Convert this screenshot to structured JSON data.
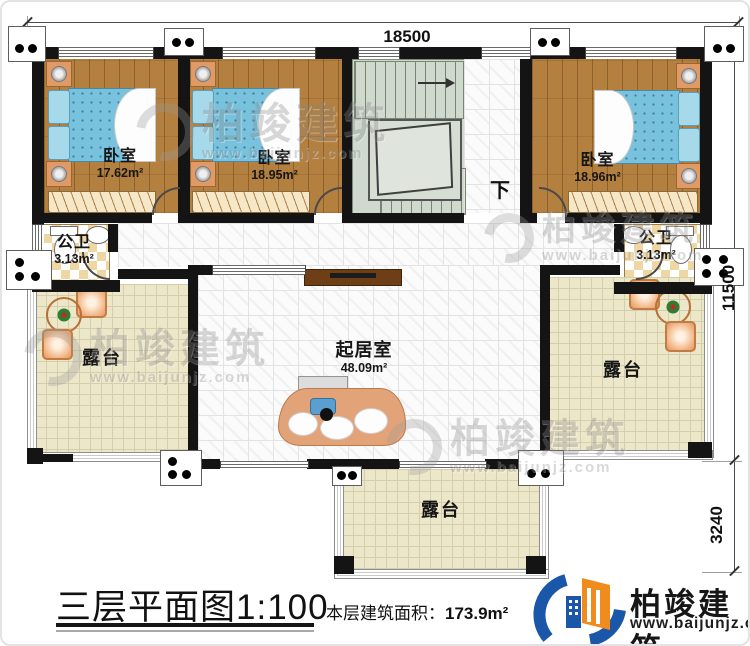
{
  "plan": {
    "title": "三层平面图1:100",
    "floor_area_label": "本层建筑面积：",
    "floor_area_value": "173.9m²",
    "dimensions": {
      "top": "18500",
      "right_upper": "11500",
      "right_lower": "3240"
    },
    "stairs_down_label": "下"
  },
  "rooms": {
    "bedroom1": {
      "name": "卧室",
      "area": "17.62m²"
    },
    "bedroom2": {
      "name": "卧室",
      "area": "18.95m²"
    },
    "bedroom3": {
      "name": "卧室",
      "area": "18.96m²"
    },
    "bath_left": {
      "name": "公卫",
      "area": "3.13m²"
    },
    "bath_right": {
      "name": "公卫",
      "area": "3.13m²"
    },
    "living_room": {
      "name": "起居室",
      "area": "48.09m²"
    },
    "terrace_left": {
      "name": "露台"
    },
    "terrace_right": {
      "name": "露台"
    },
    "terrace_bottom": {
      "name": "露台"
    }
  },
  "brand": {
    "name": "柏竣建筑",
    "website": "www.baijunjz.com"
  },
  "watermark": {
    "name": "柏竣建筑",
    "website": "www.baijunjz.com"
  },
  "colors": {
    "wall": "#141414",
    "wood_floor": "#b48040",
    "bed_blue": "#79c2dd",
    "terrace_tile": "#ece7c9",
    "stairs": "#cfd9cd",
    "brand_blue": "#1a57a8",
    "brand_orange": "#f08c1e"
  }
}
